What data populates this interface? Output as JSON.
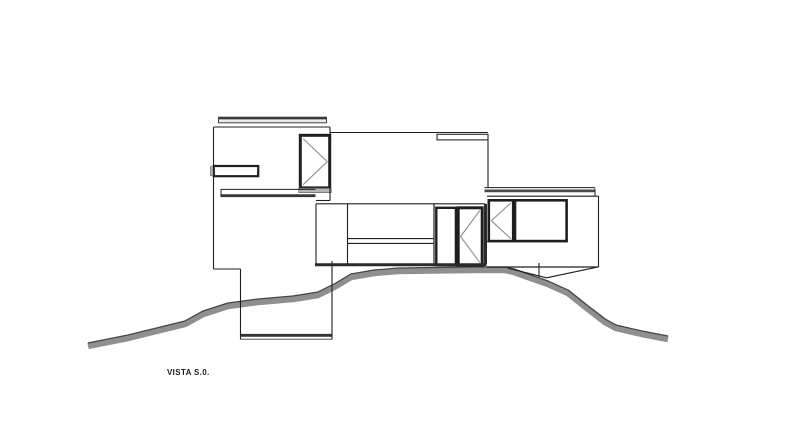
{
  "canvas": {
    "width": 800,
    "height": 432,
    "background": "#ffffff"
  },
  "caption": {
    "text": "VISTA S.0."
  },
  "colors": {
    "line": "#1f1f1f",
    "thick": "#2a2a2a",
    "dark_band": "#3a3a3a",
    "glaze_mark": "#8f8f8f",
    "sill": "#b5b5b5",
    "slab_fill": "#ececec",
    "terrain_fill": "#8f8f8f",
    "terrain_edge": "#454545"
  },
  "elevation": {
    "terrain": {
      "points": [
        [
          88,
          343
        ],
        [
          128,
          335
        ],
        [
          185,
          321
        ],
        [
          203,
          311
        ],
        [
          228,
          303
        ],
        [
          258,
          299
        ],
        [
          293,
          296
        ],
        [
          318,
          292
        ],
        [
          336,
          283
        ],
        [
          351,
          274
        ],
        [
          374,
          270
        ],
        [
          398,
          268
        ],
        [
          470,
          267
        ],
        [
          505,
          267
        ],
        [
          514,
          269
        ],
        [
          548,
          281
        ],
        [
          568,
          290
        ],
        [
          588,
          306
        ],
        [
          605,
          319
        ],
        [
          616,
          325
        ],
        [
          642,
          331
        ],
        [
          668,
          336
        ]
      ],
      "band_color": "#8f8f8f",
      "band_width": 6.5,
      "band_offset": 3,
      "edge_color": "#454545",
      "edge_width": 1.2
    },
    "rects": [
      {
        "name": "left-roof-slab",
        "x": 218.5,
        "y": 117.2,
        "w": 108,
        "h": 5.6,
        "sw": 1,
        "stroke": "#444444",
        "fill": "#ececec"
      },
      {
        "name": "mid-parapet-slab",
        "x": 437,
        "y": 134.3,
        "w": 51,
        "h": 5.6,
        "sw": 1.1,
        "stroke": "#2a2a2a",
        "fill": "#ffffff"
      },
      {
        "name": "left-slot-window",
        "x": 213.8,
        "y": 166,
        "w": 44.4,
        "h": 10.2,
        "sw": 2.2,
        "stroke": "#1f1f1f",
        "fill": "#ffffff"
      },
      {
        "name": "left-slot-window-tab",
        "x": 210.3,
        "y": 166.6,
        "w": 3.5,
        "h": 9,
        "sw": 0.6,
        "stroke": "#777777",
        "fill": "#b0b0b0"
      },
      {
        "name": "left-casement-window",
        "x": 300.3,
        "y": 135.3,
        "w": 29.4,
        "h": 52.6,
        "sw": 3,
        "stroke": "#1f1f1f",
        "fill": "#ffffff"
      },
      {
        "name": "left-window-sill",
        "x": 298.8,
        "y": 188.3,
        "w": 32.4,
        "h": 4.2,
        "sw": 0.8,
        "stroke": "#666666",
        "fill": "#b5b5b5"
      },
      {
        "name": "mid-door-panel",
        "x": 436.3,
        "y": 207.8,
        "w": 19.6,
        "h": 57.4,
        "sw": 2.4,
        "stroke": "#1f1f1f",
        "fill": "#ffffff"
      },
      {
        "name": "mid-casement-door",
        "x": 458.2,
        "y": 207.8,
        "w": 24,
        "h": 57.4,
        "sw": 3,
        "stroke": "#1f1f1f",
        "fill": "#ffffff"
      },
      {
        "name": "right-casement-window",
        "x": 488.8,
        "y": 200.3,
        "w": 24.4,
        "h": 40.8,
        "sw": 2.6,
        "stroke": "#1f1f1f",
        "fill": "#ffffff"
      },
      {
        "name": "right-picture-window",
        "x": 515,
        "y": 200.3,
        "w": 51.6,
        "h": 40.8,
        "sw": 2.6,
        "stroke": "#1f1f1f",
        "fill": "#ffffff"
      }
    ],
    "lines": [
      {
        "name": "left-block-wall",
        "p": [
          213.5,
          127,
          213.5,
          269
        ],
        "w": 1.1
      },
      {
        "name": "left-block-top",
        "p": [
          213.5,
          127,
          330,
          127
        ],
        "w": 1.1
      },
      {
        "name": "left-block-right-edge",
        "p": [
          330,
          127,
          330,
          200.5
        ],
        "w": 1.1
      },
      {
        "name": "left-block-step",
        "p": [
          316,
          200.5,
          330,
          200.5
        ],
        "w": 1.1
      },
      {
        "name": "left-roofbar-topline",
        "p": [
          218.5,
          118.2,
          326.5,
          118.2
        ],
        "w": 2.4,
        "c": "#3a3a3a"
      },
      {
        "name": "left-floorband-top",
        "p": [
          221,
          189.4,
          315.5,
          189.4
        ],
        "w": 1
      },
      {
        "name": "left-floorband-bottom",
        "p": [
          221,
          195.7,
          315.5,
          195.7
        ],
        "w": 2.8,
        "c": "#3a3a3a"
      },
      {
        "name": "left-floorband-end",
        "p": [
          221,
          189,
          221,
          197
        ],
        "w": 1
      },
      {
        "name": "plinth-step",
        "p": [
          213.5,
          269,
          240.5,
          269
        ],
        "w": 1.1
      },
      {
        "name": "plinth-left-edge",
        "p": [
          240.5,
          269,
          240.5,
          339.5
        ],
        "w": 1.1
      },
      {
        "name": "plinth-right-edge",
        "p": [
          332,
          261,
          332,
          339.5
        ],
        "w": 1.1
      },
      {
        "name": "plinth-bottom-thick",
        "p": [
          240.5,
          335.3,
          332,
          335.3
        ],
        "w": 2.8,
        "c": "#333333"
      },
      {
        "name": "plinth-bottom-thin",
        "p": [
          240.5,
          339.2,
          332,
          339.2
        ],
        "w": 1,
        "c": "#555555"
      },
      {
        "name": "upper-mid-top-edge",
        "p": [
          330,
          132.5,
          488,
          132.5
        ],
        "w": 1.1
      },
      {
        "name": "upper-mid-right-edge",
        "p": [
          488,
          140,
          488,
          187.5
        ],
        "w": 1.1
      },
      {
        "name": "mid-block-top",
        "p": [
          316,
          203.8,
          485,
          203.8
        ],
        "w": 1.2
      },
      {
        "name": "mid-block-left",
        "p": [
          316,
          203.8,
          316,
          263.5
        ],
        "w": 1.1
      },
      {
        "name": "mid-divider-1",
        "p": [
          347.5,
          203.8,
          347.5,
          263.5
        ],
        "w": 1.1
      },
      {
        "name": "mid-rail-top",
        "p": [
          347.5,
          238.6,
          434,
          238.6
        ],
        "w": 1.1
      },
      {
        "name": "mid-rail-bottom",
        "p": [
          347.5,
          243.4,
          434,
          243.4
        ],
        "w": 1.1
      },
      {
        "name": "mid-divider-2",
        "p": [
          434,
          203.8,
          434,
          263.5
        ],
        "w": 1.2
      },
      {
        "name": "mid-block-bottom",
        "p": [
          315,
          264.8,
          486.5,
          264.8
        ],
        "w": 3,
        "c": "#2a2a2a"
      },
      {
        "name": "mid-block-right",
        "p": [
          485.5,
          203.8,
          485.5,
          264
        ],
        "w": 3,
        "c": "#2a2a2a"
      },
      {
        "name": "right-roof-topline",
        "p": [
          484.5,
          187.6,
          595,
          187.6
        ],
        "w": 1
      },
      {
        "name": "right-roof-band",
        "p": [
          484.5,
          190.9,
          595,
          190.9
        ],
        "w": 2.8,
        "c": "#4a4a4a"
      },
      {
        "name": "right-roof-step",
        "p": [
          595,
          188.5,
          595,
          196
        ],
        "w": 1
      },
      {
        "name": "right-block-top",
        "p": [
          487,
          196.2,
          598.5,
          196.2
        ],
        "w": 1.2
      },
      {
        "name": "right-block-right",
        "p": [
          598.5,
          196.2,
          598.5,
          267
        ],
        "w": 1.1
      },
      {
        "name": "right-block-bottom",
        "p": [
          487,
          267,
          598.5,
          267
        ],
        "w": 1.2
      },
      {
        "name": "right-sill-line",
        "p": [
          487,
          241.6,
          566,
          241.6
        ],
        "w": 1
      },
      {
        "name": "keel-left",
        "p": [
          508,
          268.2,
          546.5,
          277.8
        ],
        "w": 1.1
      },
      {
        "name": "keel-right",
        "p": [
          546.5,
          277.8,
          596.5,
          267.3
        ],
        "w": 1.1
      },
      {
        "name": "keel-post",
        "p": [
          539,
          263,
          539,
          277
        ],
        "w": 1.1
      }
    ],
    "marks": [
      {
        "name": "left-casement-glazing-mark",
        "points": "303,138.5 327.2,161.6 303,184.8",
        "w": 1.1
      },
      {
        "name": "mid-casement-glazing-mark",
        "points": "479.8,210.5 460.6,236.5 479.8,262.6",
        "w": 1.1
      },
      {
        "name": "right-casement-glazing-mark",
        "points": "510.8,203 491.4,220.7 510.8,238.6",
        "w": 1.1
      }
    ]
  }
}
